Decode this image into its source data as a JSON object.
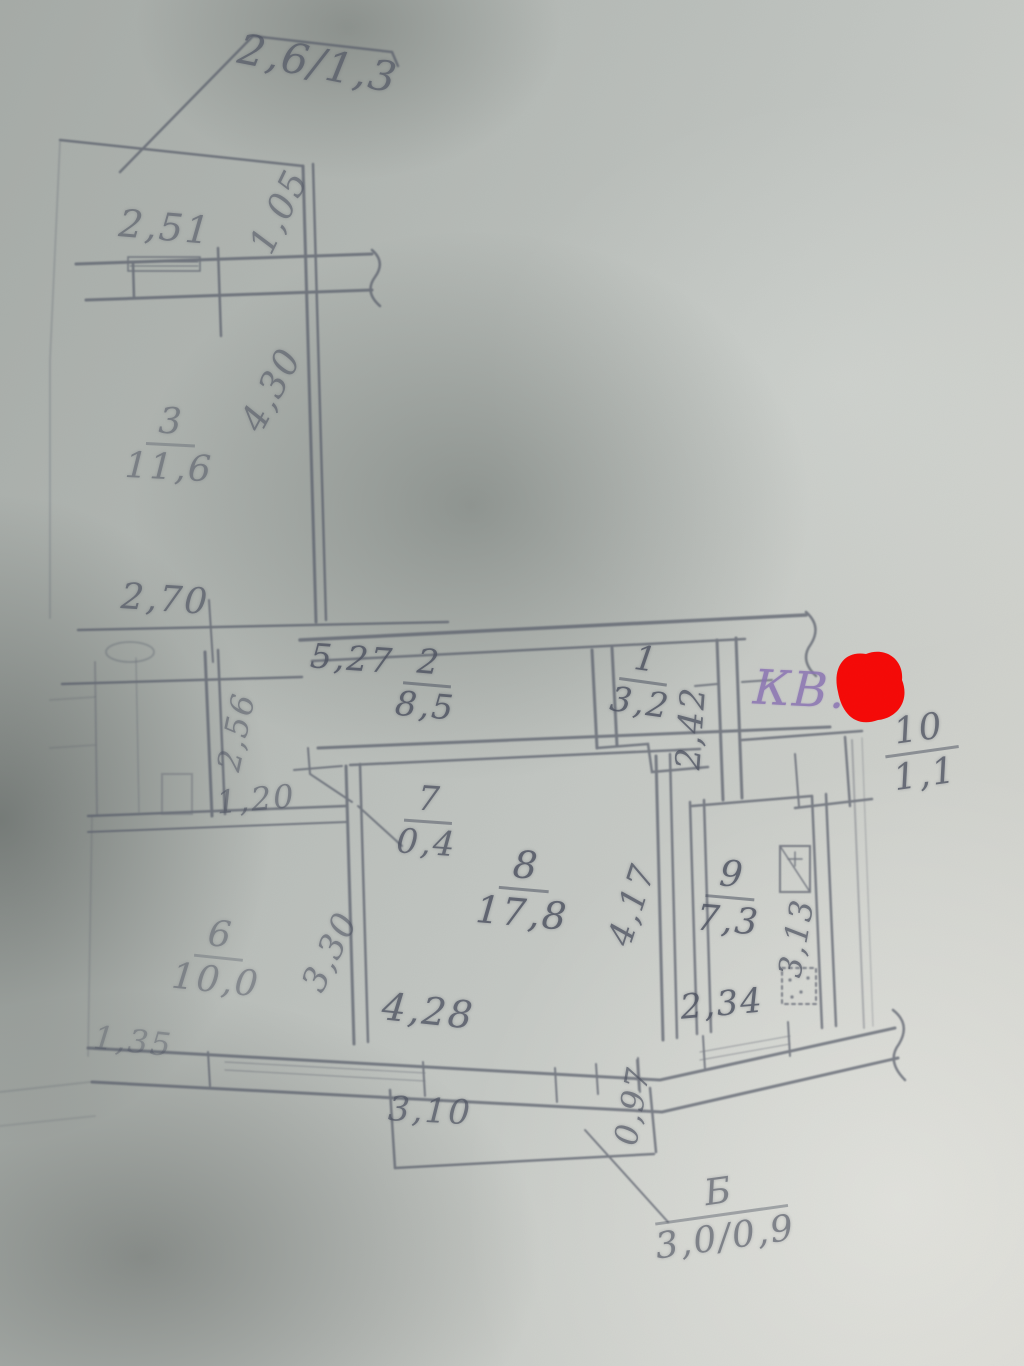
{
  "document": {
    "type_hint": "hand-drawn apartment floor plan photo",
    "apartment_label": "КВ."
  },
  "colors": {
    "pencil": "#4f5462",
    "ink_purple": "#8b74b4",
    "redaction_red": "#f70806",
    "paper": "#c2c6c2"
  },
  "rooms": {
    "r1": {
      "number": "1",
      "area": "3,2"
    },
    "r2": {
      "number": "2",
      "area": "8,5"
    },
    "r3": {
      "number": "3",
      "area": "11,6"
    },
    "r6": {
      "number": "6",
      "area": "10,0"
    },
    "r7": {
      "number": "7",
      "area": "0,4"
    },
    "r8": {
      "number": "8",
      "area": "17,8"
    },
    "r9": {
      "number": "9",
      "area": "7,3"
    },
    "r10": {
      "number": "10",
      "area": "1,1"
    },
    "balcony": {
      "number": "Б",
      "area": "3,0/0,9"
    }
  },
  "dims": {
    "d2_6_1_3": "2,6/1,3",
    "d2_51": "2,51",
    "d1_05": "1,05",
    "d4_30": "4,30",
    "d2_70": "2,70",
    "d5_27": "5,27",
    "d2_42": "2,42",
    "d2_56": "2,56",
    "d1_20": "1,20",
    "d4_17": "4,17",
    "d3_13": "3,13",
    "d3_30": "3,30",
    "d1_35": "1,35",
    "d4_28": "4,28",
    "d2_34": "2,34",
    "d3_10": "3,10",
    "d0_97": "0,97"
  }
}
